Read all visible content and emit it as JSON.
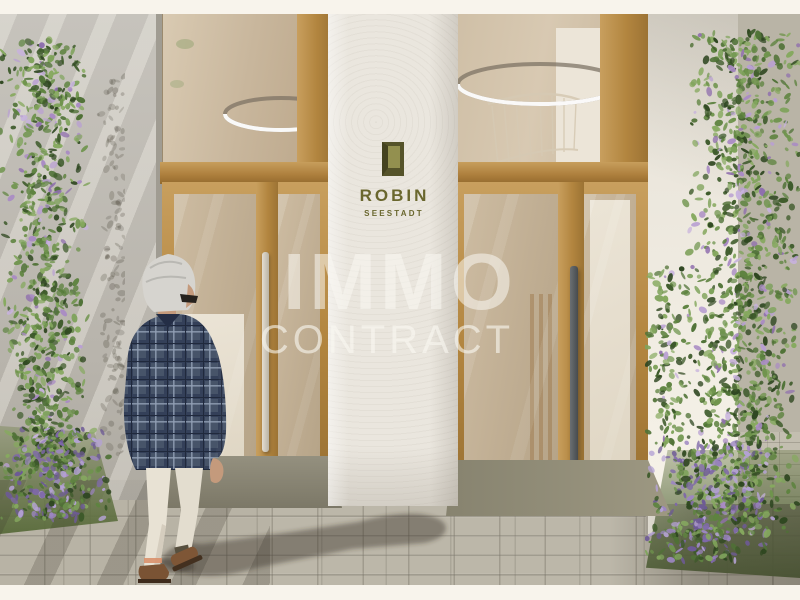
{
  "branding": {
    "name": "ROBIN",
    "subtitle": "SEESTADT",
    "logo_color": "#6a672e",
    "door_icon": "door-icon"
  },
  "watermark": {
    "line1": "IMMO",
    "line2": "CONTRACT",
    "color": "#faf8f2"
  },
  "scene": {
    "type": "architectural-exterior-rendering",
    "elements": [
      "building-entrance",
      "oak-framed-glass-double-doors",
      "brand-pillar",
      "ring-pendant-lights",
      "staircase-railing",
      "climbing-plants-purple-flowers",
      "stone-paver-walkway",
      "door-mats",
      "walking-man-gray-hair-plaid-blazer",
      "cast-shadow"
    ],
    "palette": {
      "letterbox": "#f8f4ec",
      "wood": "#b2853f",
      "plaster_pillar": "#eae6de",
      "gray_wall": "#bcb8b0",
      "white_wall": "#f2eee4",
      "glass_interior": "#c8b69c",
      "pavement": "#bcb7a9",
      "door_mat": "#8a8575",
      "foliage_green": "#5d8140",
      "flower_purple": "#9c82bd",
      "jacket_plaid": "#46536b",
      "trousers": "#e6e0d2",
      "shoes": "#7a5334"
    }
  }
}
